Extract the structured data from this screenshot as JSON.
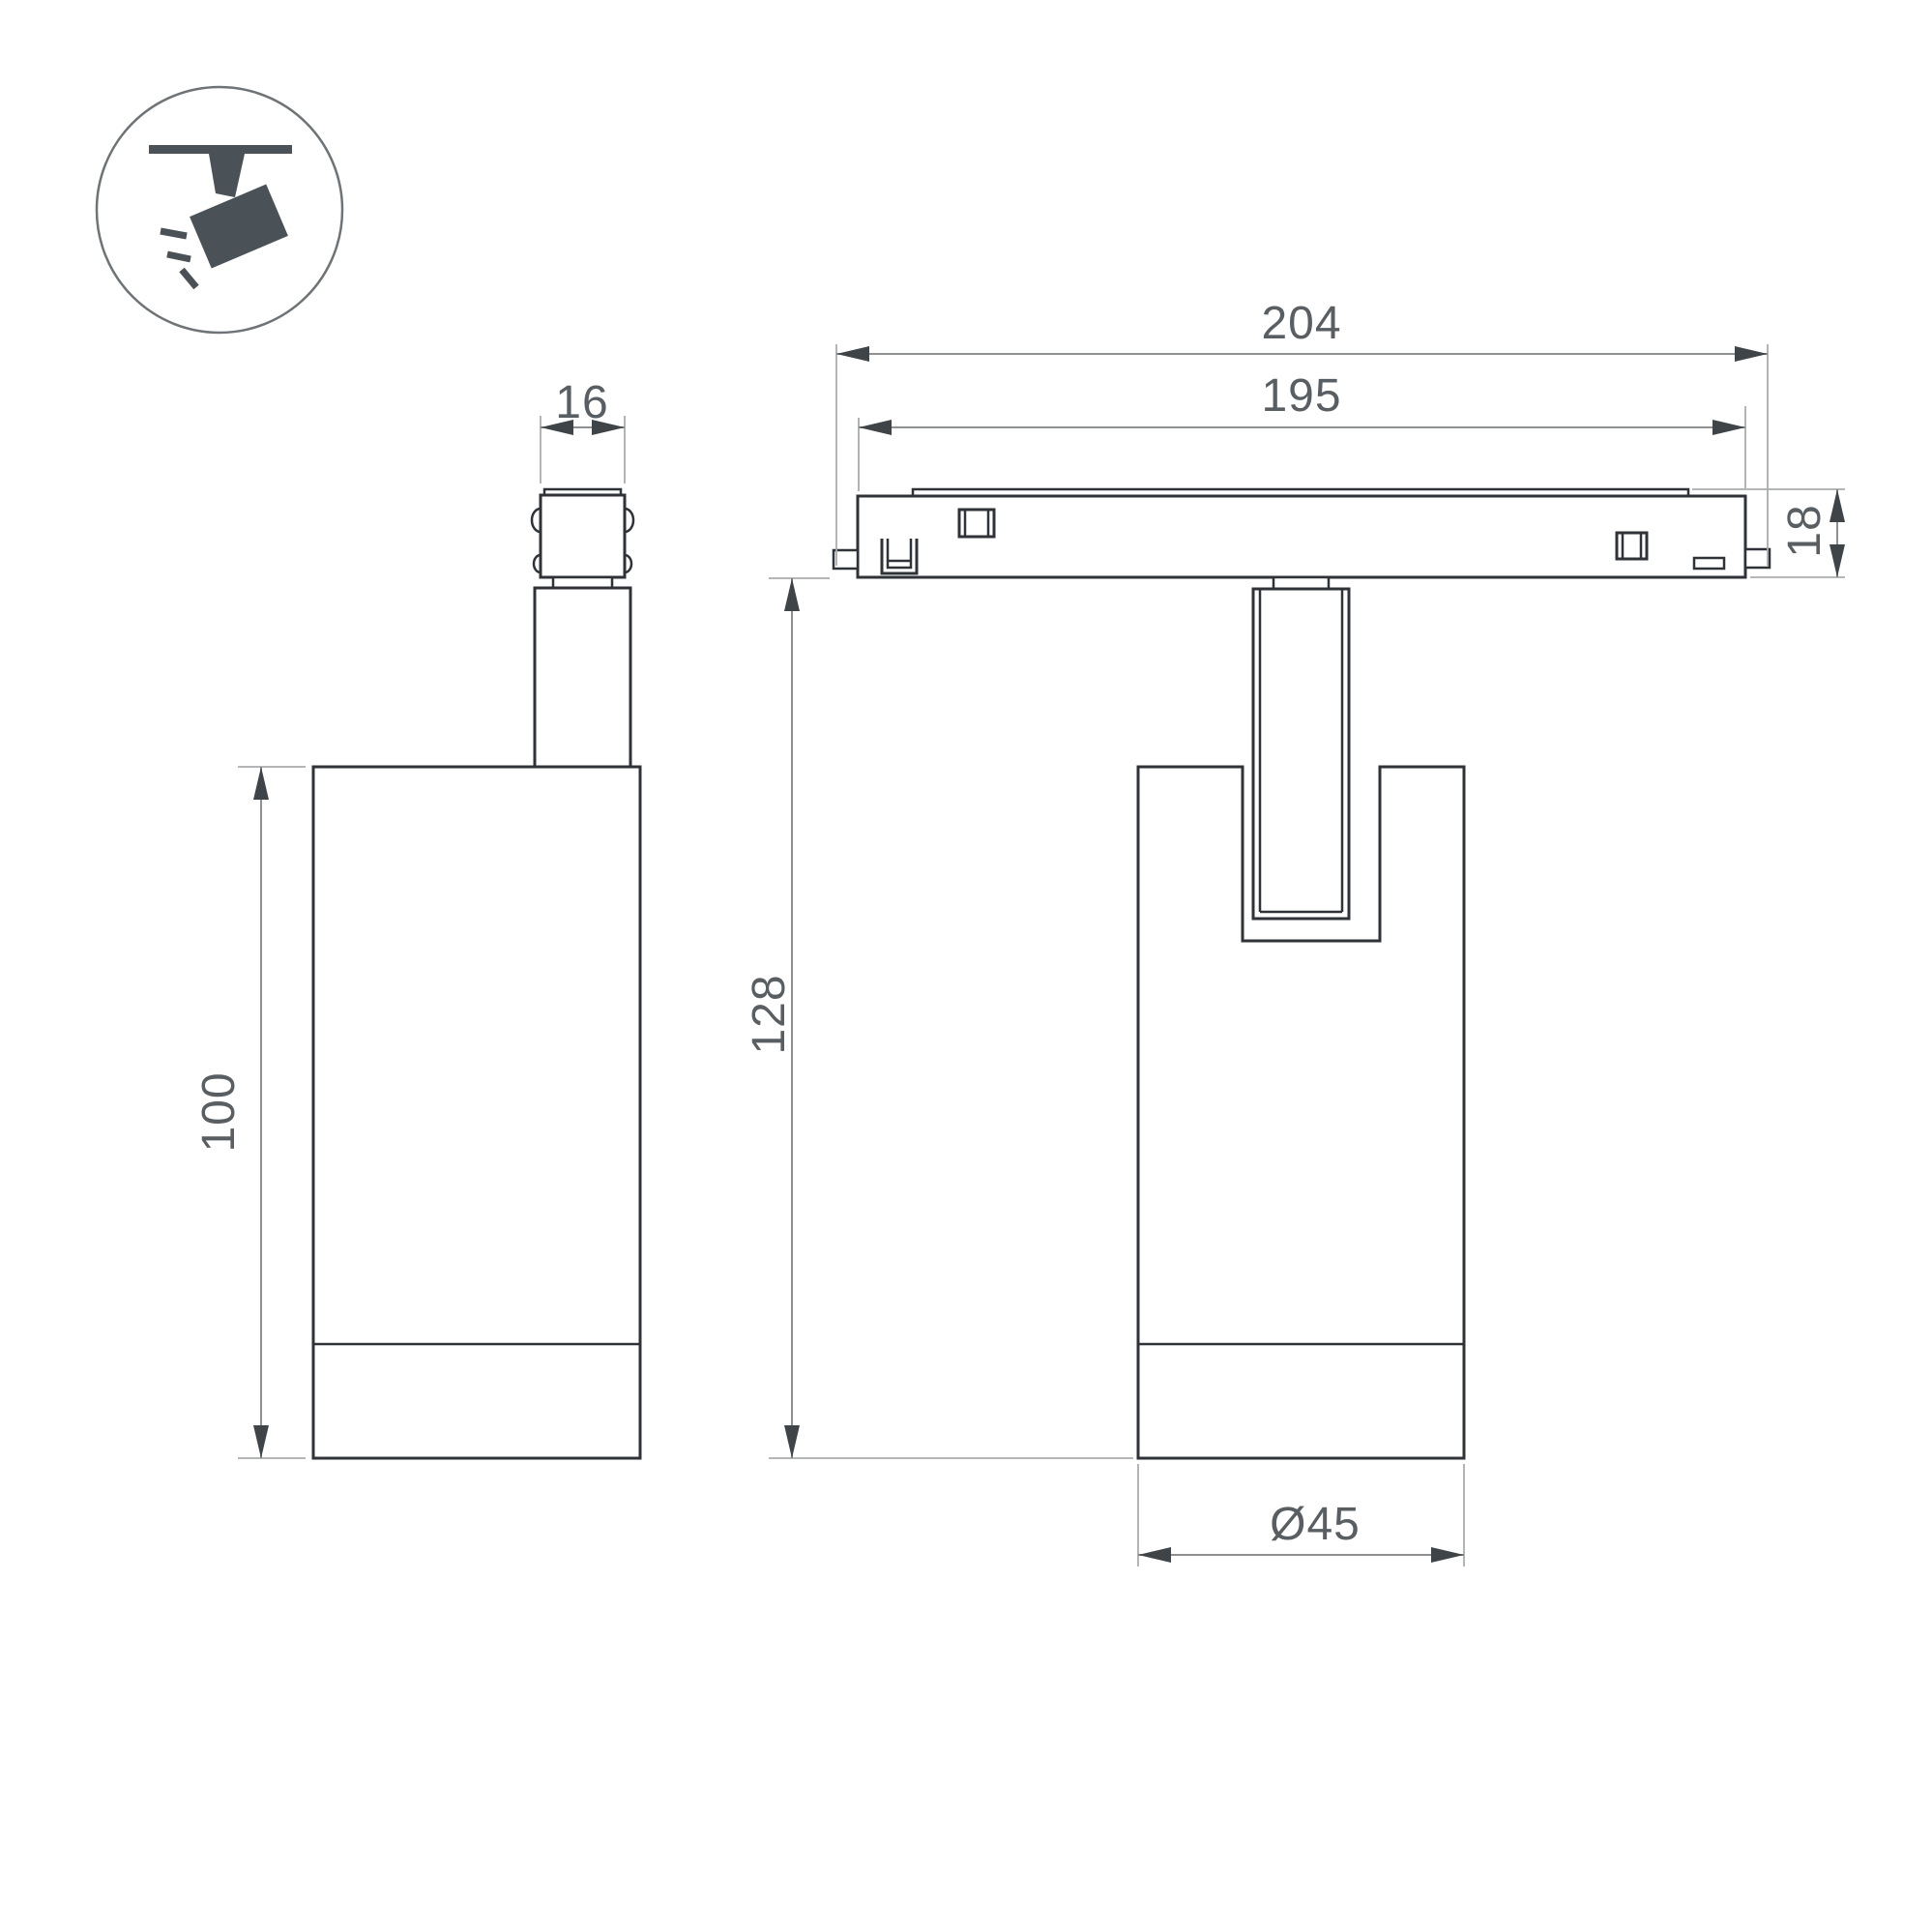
{
  "page": {
    "background": "#ffffff"
  },
  "colors": {
    "outline": "#2f3338",
    "arrow": "#3f4449",
    "dim-line": "#8e9194",
    "ext-line": "#a9acae",
    "dim-text": "#595e63",
    "icon": "#4a5157",
    "icon-ring": "#6e7377"
  },
  "icon": {
    "name": "track-spotlight-icon"
  },
  "dimensions": {
    "connector_width": "16",
    "overall_length": "204",
    "body_length": "195",
    "track_height": "18",
    "housing_height": "100",
    "total_height": "128",
    "diameter": "Ø45"
  }
}
